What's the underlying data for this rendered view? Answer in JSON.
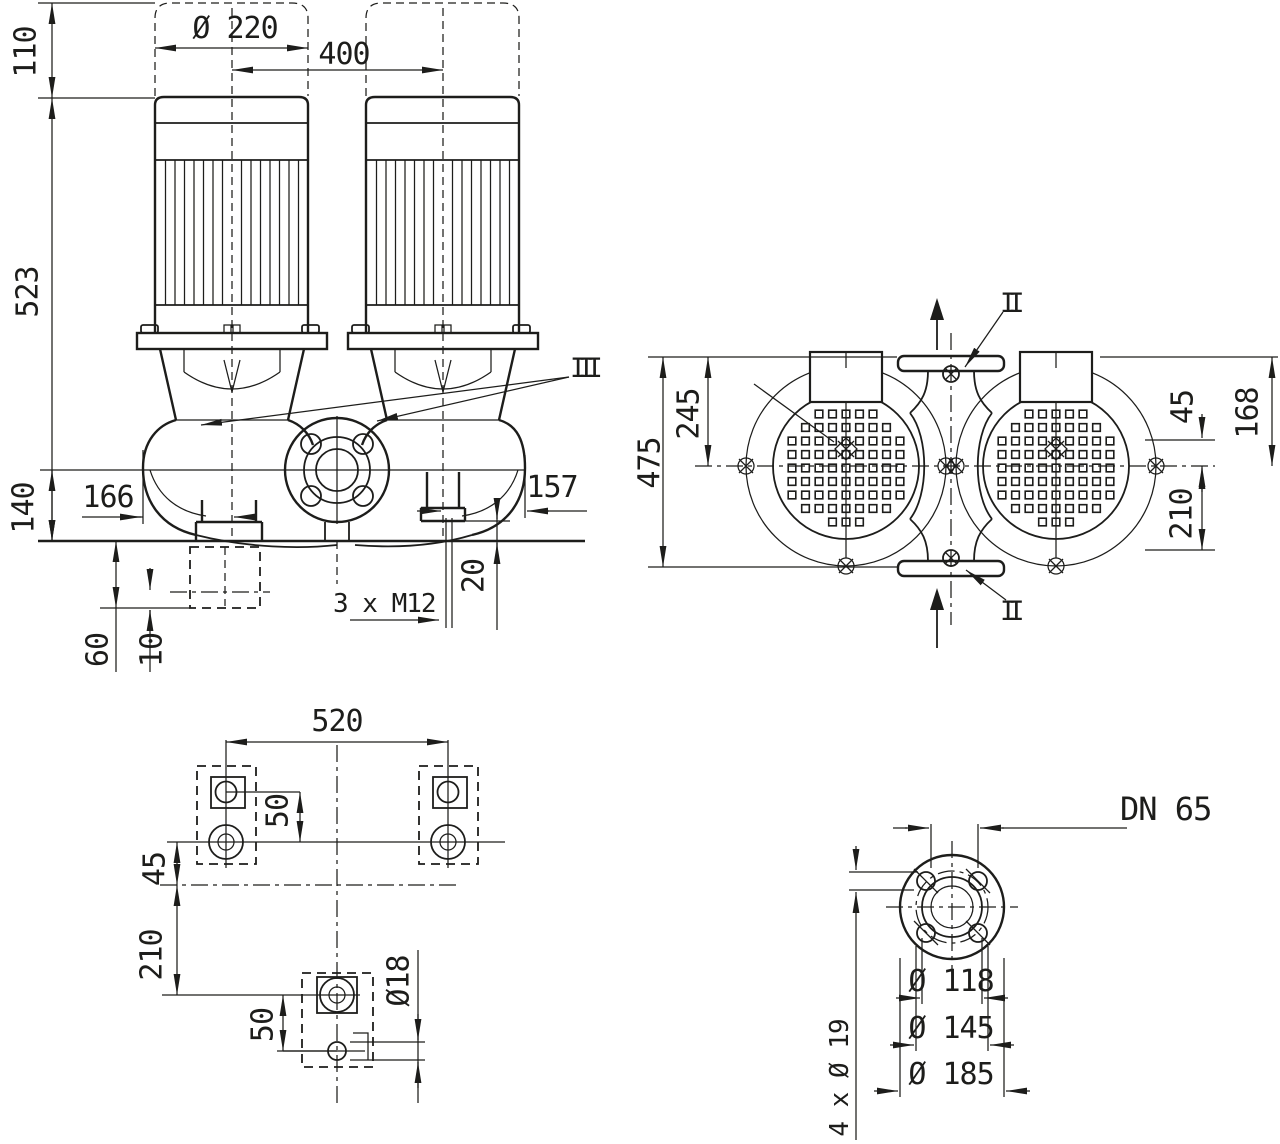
{
  "style": {
    "ink": "#1d1d1b",
    "background": "#ffffff"
  },
  "front": {
    "d110": "110",
    "d523": "523",
    "d140": "140",
    "dia220": "Ø 220",
    "d400": "400",
    "d166": "166",
    "d157": "157",
    "d20": "20",
    "bolt_note": "3 x M12",
    "d60": "60",
    "d10": "10",
    "sec": "III"
  },
  "top": {
    "d475": "475",
    "d245": "245",
    "d45": "45",
    "d168": "168",
    "d210": "210",
    "sec_top": "II",
    "sec_bot": "II"
  },
  "plan": {
    "d520": "520",
    "d50a": "50",
    "d45": "45",
    "d210": "210",
    "d50b": "50",
    "dia18": "Ø18"
  },
  "flange": {
    "dn": "DN 65",
    "dia118": "Ø 118",
    "dia145": "Ø 145",
    "dia185": "Ø 185",
    "holes": "4 x Ø 19"
  }
}
